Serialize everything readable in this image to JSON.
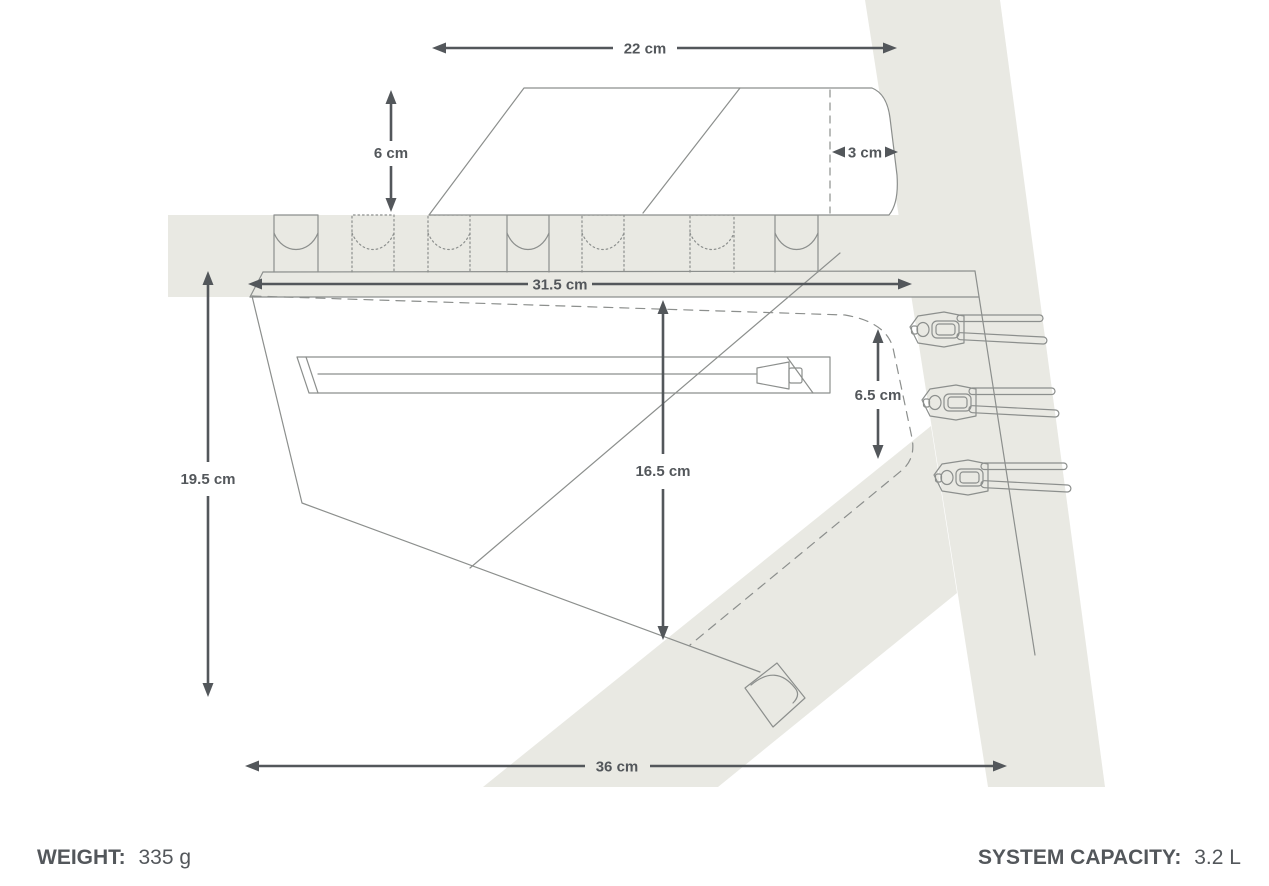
{
  "diagram": {
    "dimensions": {
      "top_bag_width": "22 cm",
      "top_bag_height": "6 cm",
      "top_bag_offset": "3 cm",
      "frame_bag_top_length": "31.5 cm",
      "frame_bag_left_height": "19.5 cm",
      "frame_bag_center_height": "16.5 cm",
      "frame_bag_right_height": "6.5 cm",
      "frame_bag_bottom_length": "36 cm"
    },
    "colors": {
      "background": "#ffffff",
      "frame_fill": "#e9e9e3",
      "outline": "#8c8f8d",
      "dimension": "#53575b"
    }
  },
  "footer": {
    "weight_label": "WEIGHT:",
    "weight_value": "335 g",
    "capacity_label": "SYSTEM CAPACITY:",
    "capacity_value": "3.2 L"
  }
}
